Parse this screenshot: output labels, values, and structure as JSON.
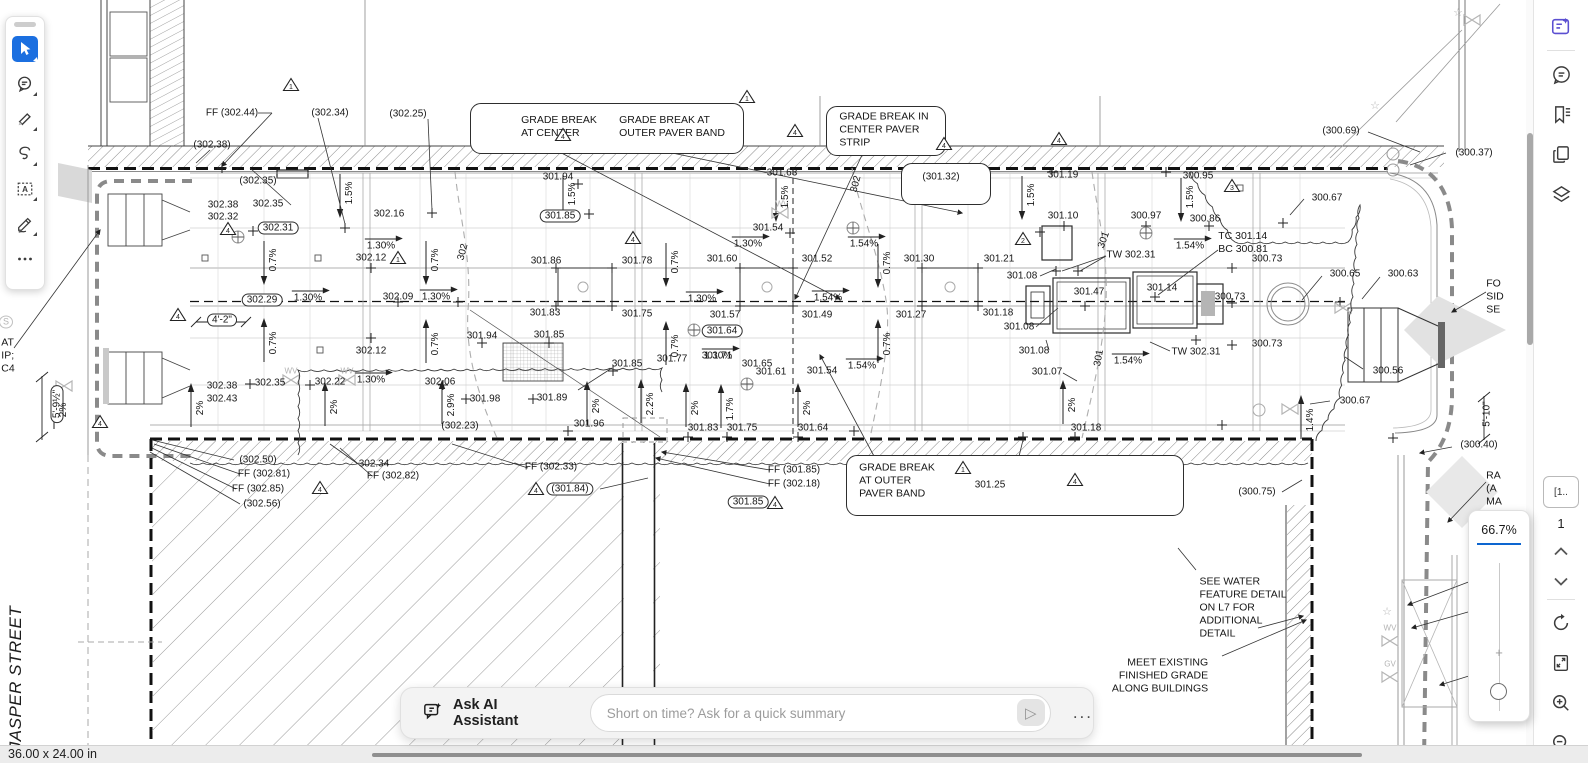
{
  "zoom_popup": {
    "value": "66.7%"
  },
  "sidebar_right": {
    "page_box_label": "[1..",
    "page_number": "1"
  },
  "ai_bar": {
    "label": "Ask AI Assistant",
    "placeholder": "Short on time? Ask for a quick summary",
    "more_label": "..."
  },
  "status_bar": {
    "page_size": "36.00 x 24.00 in"
  },
  "plan": {
    "street": "JASPER STREET",
    "labels": [
      {
        "t": "FF (302.44)",
        "x": 232,
        "y": 113
      },
      {
        "t": "(302.34)",
        "x": 330,
        "y": 113
      },
      {
        "t": "(302.25)",
        "x": 408,
        "y": 114
      },
      {
        "t": "(302.38)",
        "x": 212,
        "y": 145
      },
      {
        "t": "(302.35)",
        "x": 258,
        "y": 181
      },
      {
        "t": "301.94",
        "x": 558,
        "y": 177
      },
      {
        "t": "302.16",
        "x": 389,
        "y": 214
      },
      {
        "t": "301.85",
        "x": 560,
        "y": 216,
        "cls": "c"
      },
      {
        "t": "301.63",
        "x": 782,
        "y": 173
      },
      {
        "t": "301.54",
        "x": 768,
        "y": 228
      },
      {
        "t": "(301.32)",
        "x": 941,
        "y": 177
      },
      {
        "t": "301.19",
        "x": 1063,
        "y": 175
      },
      {
        "t": "301.10",
        "x": 1063,
        "y": 216
      },
      {
        "t": "300.95",
        "x": 1198,
        "y": 176
      },
      {
        "t": "300.97",
        "x": 1146,
        "y": 216
      },
      {
        "t": "300.86",
        "x": 1205,
        "y": 219
      },
      {
        "t": "(300.69)",
        "x": 1341,
        "y": 131
      },
      {
        "t": "(300.37)",
        "x": 1474,
        "y": 153
      },
      {
        "t": "300.67",
        "x": 1327,
        "y": 198
      },
      {
        "t": "302.38",
        "x": 223,
        "y": 205
      },
      {
        "t": "302.32",
        "x": 223,
        "y": 217
      },
      {
        "t": "302.35",
        "x": 268,
        "y": 204
      },
      {
        "t": "302.31",
        "x": 278,
        "y": 228,
        "cls": "c"
      },
      {
        "t": "302.12",
        "x": 371,
        "y": 258
      },
      {
        "t": "301.86",
        "x": 546,
        "y": 261
      },
      {
        "t": "301.78",
        "x": 637,
        "y": 261
      },
      {
        "t": "302.29",
        "x": 262,
        "y": 300,
        "cls": "c"
      },
      {
        "t": "302.09",
        "x": 398,
        "y": 297
      },
      {
        "t": "4'-2\"",
        "x": 222,
        "y": 320,
        "cls": "c"
      },
      {
        "t": "301.83",
        "x": 545,
        "y": 313
      },
      {
        "t": "301.75",
        "x": 637,
        "y": 314
      },
      {
        "t": "301.60",
        "x": 722,
        "y": 259
      },
      {
        "t": "301.52",
        "x": 817,
        "y": 259
      },
      {
        "t": "301.30",
        "x": 919,
        "y": 259
      },
      {
        "t": "301.21",
        "x": 999,
        "y": 259
      },
      {
        "t": "301.57",
        "x": 725,
        "y": 315
      },
      {
        "t": "301.49",
        "x": 817,
        "y": 315
      },
      {
        "t": "301.27",
        "x": 911,
        "y": 315
      },
      {
        "t": "301.18",
        "x": 998,
        "y": 313
      },
      {
        "t": "302.12",
        "x": 371,
        "y": 351
      },
      {
        "t": "301.94",
        "x": 482,
        "y": 336
      },
      {
        "t": "301.85",
        "x": 549,
        "y": 335
      },
      {
        "t": "301.64",
        "x": 722,
        "y": 331,
        "cls": "c"
      },
      {
        "t": "301.77",
        "x": 672,
        "y": 359
      },
      {
        "t": "301.71",
        "x": 717,
        "y": 356
      },
      {
        "t": "301.65",
        "x": 757,
        "y": 364
      },
      {
        "t": "301.61",
        "x": 771,
        "y": 372
      },
      {
        "t": "301.54",
        "x": 822,
        "y": 371
      },
      {
        "t": "301.08",
        "x": 1022,
        "y": 276
      },
      {
        "t": "301.08",
        "x": 1019,
        "y": 327
      },
      {
        "t": "301.08",
        "x": 1034,
        "y": 351
      },
      {
        "t": "301.07",
        "x": 1047,
        "y": 372
      },
      {
        "t": "301.47",
        "x": 1089,
        "y": 292
      },
      {
        "t": "301.14",
        "x": 1162,
        "y": 288
      },
      {
        "t": "TW 302.31",
        "x": 1131,
        "y": 255
      },
      {
        "t": "TW 302.31",
        "x": 1196,
        "y": 352
      },
      {
        "t": "300.73",
        "x": 1267,
        "y": 259
      },
      {
        "t": "300.73",
        "x": 1230,
        "y": 297
      },
      {
        "t": "300.73",
        "x": 1267,
        "y": 344
      },
      {
        "t": "300.65",
        "x": 1345,
        "y": 274
      },
      {
        "t": "300.63",
        "x": 1403,
        "y": 274
      },
      {
        "t": "300.56",
        "x": 1388,
        "y": 371
      },
      {
        "t": "300.67",
        "x": 1355,
        "y": 401
      },
      {
        "t": "(300.40)",
        "x": 1479,
        "y": 445
      },
      {
        "t": "(300.75)",
        "x": 1257,
        "y": 492
      },
      {
        "t": "302.38",
        "x": 222,
        "y": 386
      },
      {
        "t": "302.43",
        "x": 222,
        "y": 399
      },
      {
        "t": "302.35",
        "x": 270,
        "y": 383
      },
      {
        "t": "302.22",
        "x": 330,
        "y": 382
      },
      {
        "t": "302.06",
        "x": 440,
        "y": 382
      },
      {
        "t": "301.98",
        "x": 485,
        "y": 399
      },
      {
        "t": "301.89",
        "x": 552,
        "y": 398
      },
      {
        "t": "301.85",
        "x": 627,
        "y": 364
      },
      {
        "t": "(302.23)",
        "x": 460,
        "y": 426
      },
      {
        "t": "301.96",
        "x": 589,
        "y": 424
      },
      {
        "t": "301.83",
        "x": 703,
        "y": 428
      },
      {
        "t": "301.75",
        "x": 742,
        "y": 428
      },
      {
        "t": "301.64",
        "x": 813,
        "y": 428
      },
      {
        "t": "301.18",
        "x": 1086,
        "y": 428
      },
      {
        "t": "(302.50)",
        "x": 258,
        "y": 460
      },
      {
        "t": "FF (302.81)",
        "x": 264,
        "y": 474
      },
      {
        "t": "FF (302.85)",
        "x": 258,
        "y": 489
      },
      {
        "t": "(302.56)",
        "x": 262,
        "y": 504
      },
      {
        "t": "302.34",
        "x": 374,
        "y": 464
      },
      {
        "t": "FF (302.82)",
        "x": 393,
        "y": 476
      },
      {
        "t": "FF (302.33)",
        "x": 551,
        "y": 467
      },
      {
        "t": "(301.84)",
        "x": 570,
        "y": 489,
        "cls": "c"
      },
      {
        "t": "FF (301.85)",
        "x": 794,
        "y": 470
      },
      {
        "t": "FF (302.18)",
        "x": 794,
        "y": 484
      },
      {
        "t": "301.85",
        "x": 748,
        "y": 502,
        "cls": "c"
      },
      {
        "t": "301.25",
        "x": 990,
        "y": 485
      },
      {
        "t": "5'-9½\"",
        "x": 57,
        "y": 404,
        "r": -90,
        "cls": "c"
      },
      {
        "t": "5'-10\"",
        "x": 1487,
        "y": 414,
        "r": -90
      },
      {
        "t": "302",
        "x": 463,
        "y": 252,
        "r": -75
      },
      {
        "t": "302",
        "x": 856,
        "y": 184,
        "r": -75
      },
      {
        "t": "301",
        "x": 1104,
        "y": 240,
        "r": -70
      },
      {
        "t": "301",
        "x": 1099,
        "y": 358,
        "r": -80
      },
      {
        "t": "WV",
        "x": 291,
        "y": 371,
        "cls": "g"
      },
      {
        "t": "WV",
        "x": 347,
        "y": 371,
        "cls": "g"
      },
      {
        "t": "WV",
        "x": 782,
        "y": 204,
        "cls": "g"
      },
      {
        "t": "WV",
        "x": 1390,
        "y": 628,
        "cls": "g"
      },
      {
        "t": "GV",
        "x": 1390,
        "y": 664,
        "cls": "g"
      },
      {
        "t": "S",
        "x": 6,
        "y": 322,
        "cls": "gs"
      }
    ],
    "blocks": [
      {
        "lines": [
          "GRADE BREAK",
          "AT CENTER"
        ],
        "x": 559,
        "y": 127
      },
      {
        "lines": [
          "GRADE BREAK AT",
          "OUTER PAVER BAND"
        ],
        "x": 672,
        "y": 127
      },
      {
        "lines": [
          "GRADE BREAK IN",
          "CENTER PAVER",
          "STRIP"
        ],
        "x": 884,
        "y": 130
      },
      {
        "lines": [
          "GRADE BREAK",
          "AT OUTER",
          "PAVER BAND"
        ],
        "x": 897,
        "y": 481
      },
      {
        "lines": [
          "SEE WATER",
          "FEATURE DETAIL",
          "ON L7 FOR",
          "ADDITIONAL",
          "DETAIL"
        ],
        "x": 1243,
        "y": 608
      },
      {
        "lines": [
          "MEET EXISTING",
          "FINISHED GRADE",
          "ALONG BUILDINGS"
        ],
        "x": 1160,
        "y": 676,
        "align": "right"
      },
      {
        "lines": [
          "TC 301.14",
          "BC 300.81"
        ],
        "x": 1243,
        "y": 243
      },
      {
        "lines": [
          "AT",
          "IP;",
          "C4"
        ],
        "x": 8,
        "y": 356
      },
      {
        "lines": [
          "FO",
          "SID",
          "SE"
        ],
        "x": 1495,
        "y": 297
      },
      {
        "lines": [
          "RA",
          "(A",
          "MA"
        ],
        "x": 1494,
        "y": 489
      }
    ],
    "slopes_h": [
      {
        "t": "1.30%",
        "x": 381,
        "y": 245
      },
      {
        "t": "1.30%",
        "x": 308,
        "y": 297
      },
      {
        "t": "1.30%",
        "x": 436,
        "y": 296
      },
      {
        "t": "1.30%",
        "x": 748,
        "y": 243
      },
      {
        "t": "1.30%",
        "x": 702,
        "y": 298
      },
      {
        "t": "1.30%",
        "x": 718,
        "y": 355
      },
      {
        "t": "1.30%",
        "x": 371,
        "y": 379
      },
      {
        "t": "1.54%",
        "x": 864,
        "y": 243
      },
      {
        "t": "1.54%",
        "x": 828,
        "y": 297
      },
      {
        "t": "1.54%",
        "x": 862,
        "y": 365
      },
      {
        "t": "1.54%",
        "x": 1190,
        "y": 245
      },
      {
        "t": "1.54%",
        "x": 1128,
        "y": 360
      }
    ],
    "slopes_v": [
      {
        "t": "1.5%",
        "x": 350,
        "y": 193,
        "d": "d"
      },
      {
        "t": "1.5%",
        "x": 573,
        "y": 194,
        "d": "d"
      },
      {
        "t": "1.5%",
        "x": 786,
        "y": 197,
        "d": "d"
      },
      {
        "t": "1.5%",
        "x": 1032,
        "y": 195,
        "d": "d"
      },
      {
        "t": "1.5%",
        "x": 1191,
        "y": 197,
        "d": "d"
      },
      {
        "t": "0.7%",
        "x": 274,
        "y": 260,
        "d": "d"
      },
      {
        "t": "0.7%",
        "x": 436,
        "y": 260,
        "d": "d"
      },
      {
        "t": "0.7%",
        "x": 676,
        "y": 262,
        "d": "d"
      },
      {
        "t": "0.7%",
        "x": 888,
        "y": 263,
        "d": "d"
      },
      {
        "t": "0.7%",
        "x": 274,
        "y": 343,
        "d": "u"
      },
      {
        "t": "0.7%",
        "x": 436,
        "y": 344,
        "d": "u"
      },
      {
        "t": "0.7%",
        "x": 676,
        "y": 346,
        "d": "u"
      },
      {
        "t": "0.7%",
        "x": 888,
        "y": 344,
        "d": "u"
      },
      {
        "t": "2%",
        "x": 64,
        "y": 410,
        "d": "u"
      },
      {
        "t": "2%",
        "x": 201,
        "y": 408,
        "d": "u"
      },
      {
        "t": "2%",
        "x": 335,
        "y": 407,
        "d": "u"
      },
      {
        "t": "2%",
        "x": 597,
        "y": 406,
        "d": "u"
      },
      {
        "t": "2%",
        "x": 696,
        "y": 408,
        "d": "u"
      },
      {
        "t": "2%",
        "x": 808,
        "y": 408,
        "d": "u"
      },
      {
        "t": "2%",
        "x": 1073,
        "y": 405,
        "d": "u"
      },
      {
        "t": "2.9%",
        "x": 452,
        "y": 405,
        "d": "u"
      },
      {
        "t": "2.2%",
        "x": 651,
        "y": 404,
        "d": "u"
      },
      {
        "t": "1.7%",
        "x": 731,
        "y": 409,
        "d": "u"
      },
      {
        "t": "1.4%",
        "x": 1311,
        "y": 420,
        "d": "u"
      }
    ],
    "triangles": [
      {
        "n": "1",
        "x": 291,
        "y": 87
      },
      {
        "n": "1",
        "x": 747,
        "y": 99
      },
      {
        "n": "4",
        "x": 795,
        "y": 133
      },
      {
        "n": "4",
        "x": 563,
        "y": 137
      },
      {
        "n": "4",
        "x": 944,
        "y": 146
      },
      {
        "n": "4",
        "x": 1059,
        "y": 141
      },
      {
        "n": "3",
        "x": 1232,
        "y": 188
      },
      {
        "n": "4",
        "x": 228,
        "y": 231
      },
      {
        "n": "1",
        "x": 398,
        "y": 260
      },
      {
        "n": "4",
        "x": 633,
        "y": 240
      },
      {
        "n": "2",
        "x": 1023,
        "y": 241
      },
      {
        "n": "4",
        "x": 178,
        "y": 317
      },
      {
        "n": "4",
        "x": 100,
        "y": 424
      },
      {
        "n": "4",
        "x": 320,
        "y": 490
      },
      {
        "n": "4",
        "x": 536,
        "y": 491
      },
      {
        "n": "1",
        "x": 963,
        "y": 470
      },
      {
        "n": "4",
        "x": 775,
        "y": 505
      },
      {
        "n": "4",
        "x": 1075,
        "y": 482
      }
    ],
    "cloudboxes": [
      [
        470,
        103,
        272,
        49
      ],
      [
        826,
        106,
        118,
        48
      ],
      [
        846,
        455,
        336,
        59
      ],
      [
        901,
        163,
        88,
        40
      ]
    ]
  }
}
